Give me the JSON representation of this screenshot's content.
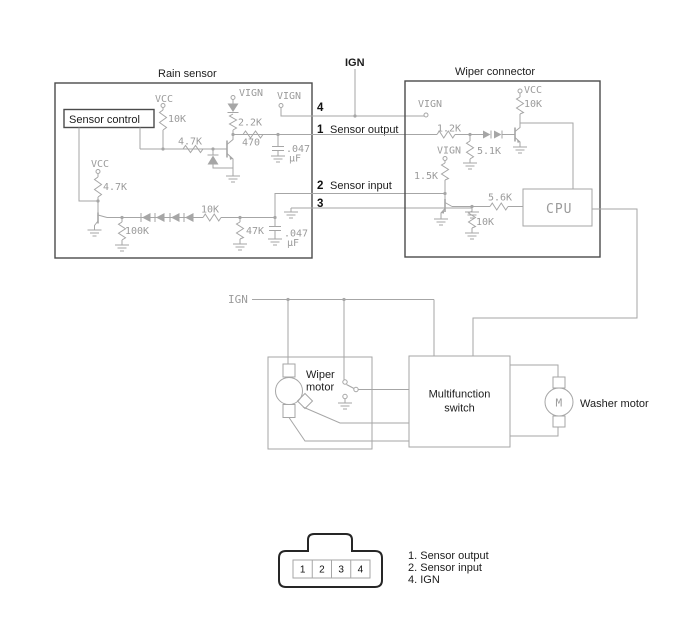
{
  "colors": {
    "circuit_line": "#a6a6a6",
    "box_border": "#4b4b4b",
    "connector_outline": "#262626",
    "gray_label": "#9b9b9b",
    "black_label": "#1c1c1c"
  },
  "rain_sensor": {
    "title": "Rain sensor",
    "sensor_control": "Sensor control",
    "vcc_top": "VCC",
    "r10k": "10K",
    "vign_diode": "VIGN",
    "r2_2k": "2.2K",
    "vign_pin4": "VIGN",
    "r4_7k_base": "4.7K",
    "r470": "470",
    "cap1_value": ".047",
    "cap1_unit": "µF",
    "vcc_left": "VCC",
    "r4_7k_left": "4.7K",
    "r100k": "100K",
    "r10k_series": "10K",
    "r47k": "47K",
    "cap2_value": ".047",
    "cap2_unit": "µF"
  },
  "wiper_connector": {
    "title": "Wiper connector",
    "vign_pin4": "VIGN",
    "vcc": "VCC",
    "r10k_pullup": "10K",
    "r1_2k": "1.2K",
    "r5_1k": "5.1K",
    "vign_mid": "VIGN",
    "r1_5k": "1.5K",
    "r5_6k": "5.6K",
    "r10k_base": "10K",
    "cpu": "CPU"
  },
  "interface": {
    "ign_top": "IGN",
    "pin4": "4",
    "pin1": "1",
    "pin1_name": "Sensor output",
    "pin2": "2",
    "pin2_name": "Sensor input",
    "pin3": "3"
  },
  "lower": {
    "ign": "IGN",
    "wiper_motor_line1": "Wiper",
    "wiper_motor_line2": "motor",
    "multifunction_line1": "Multifunction",
    "multifunction_line2": "switch",
    "washer_motor": "Washer motor",
    "motor_symbol": "M"
  },
  "connector": {
    "pin_numbers": [
      "1",
      "2",
      "3",
      "4"
    ],
    "legend": [
      "1. Sensor output",
      "2. Sensor input",
      "4. IGN"
    ]
  }
}
